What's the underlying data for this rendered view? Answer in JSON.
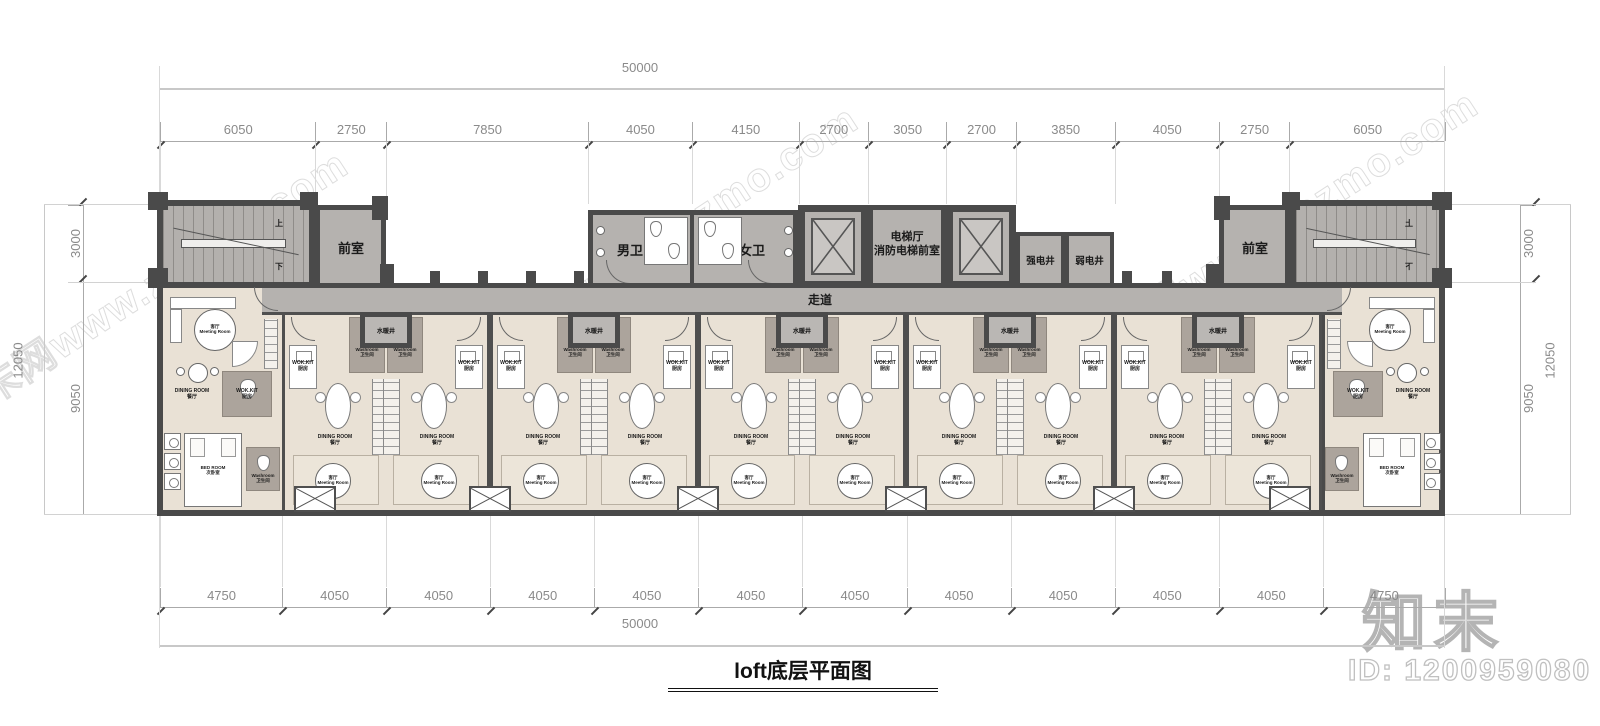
{
  "title": "loft底层平面图",
  "watermark": {
    "text": "知末网www.znzmo.com",
    "brand": "知末",
    "id": "ID: 1200959080"
  },
  "dimensions": {
    "top_total": "50000",
    "bottom_total": "50000",
    "left_total": "12050",
    "right_total": "12050",
    "top": [
      "6050",
      "2750",
      "7850",
      "4050",
      "4150",
      "2700",
      "3050",
      "2700",
      "3850",
      "4050",
      "2750",
      "6050"
    ],
    "bottom": [
      "4750",
      "4050",
      "4050",
      "4050",
      "4050",
      "4050",
      "4050",
      "4050",
      "4050",
      "4050",
      "4050",
      "4750"
    ],
    "left": [
      "3000",
      "9050"
    ],
    "right": [
      "3000",
      "9050"
    ]
  },
  "rooms": {
    "front_room_left": "前室",
    "front_room_right": "前室",
    "mens_wc": "男卫",
    "womens_wc": "女卫",
    "elevator_hall": "电梯厅\n消防电梯前室",
    "strong_electric_shaft": "强电井",
    "weak_electric_shaft": "弱电井",
    "corridor": "走道",
    "plumbing_shaft": "水暖井",
    "stair_up": "上",
    "stair_down": "下"
  },
  "unit_labels": {
    "washroom": "Washroom\n卫生间",
    "kitchen": "WOK.KIT\n厨房",
    "dining": "DINING ROOM\n餐厅",
    "living": "客厅\nMeeting Room",
    "bedroom": "BED ROOM\n次卧室"
  }
}
